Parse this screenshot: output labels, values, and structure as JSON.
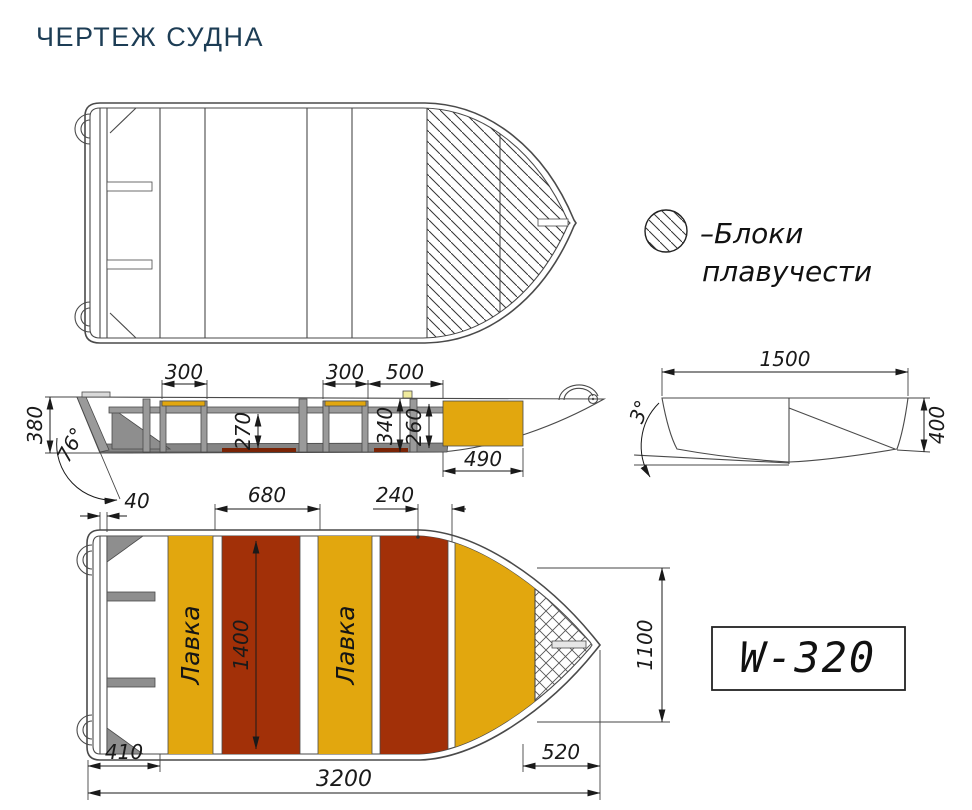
{
  "title": "ЧЕРТЕЖ СУДНА",
  "legend": {
    "line1": "–Блоки",
    "line2": "плавучести"
  },
  "model_label": "W-320",
  "colors": {
    "yellow": "#e2a70e",
    "red": "#a23008",
    "hull": "#e6e6e6",
    "structure": "#9a9a9a",
    "dark_strip": "#858585",
    "floor_red": "#7a2406",
    "light_marker": "#f0eb9e"
  },
  "views": {
    "side": {
      "dims": {
        "height_transom": "380",
        "transom_angle": "76°",
        "bench1_width": "300",
        "bench2_width": "300",
        "bow_deck_gap": "500",
        "underseat_height": "270",
        "bow_inner_height": "340",
        "bow_box_height": "260",
        "bow_box_width": "490"
      }
    },
    "cross": {
      "dims": {
        "beam": "1500",
        "deadrise_angle": "3°",
        "depth": "400"
      }
    },
    "bottom": {
      "bench_label_1": "Лавка",
      "bench_label_2": "Лавка",
      "dims": {
        "transom_thickness": "40",
        "bench_gap": "680",
        "bow_red_width": "240",
        "inner_width": "1400",
        "bow_width": "1100",
        "bow_length": "520",
        "stern_section": "410",
        "overall_length": "3200"
      }
    }
  }
}
